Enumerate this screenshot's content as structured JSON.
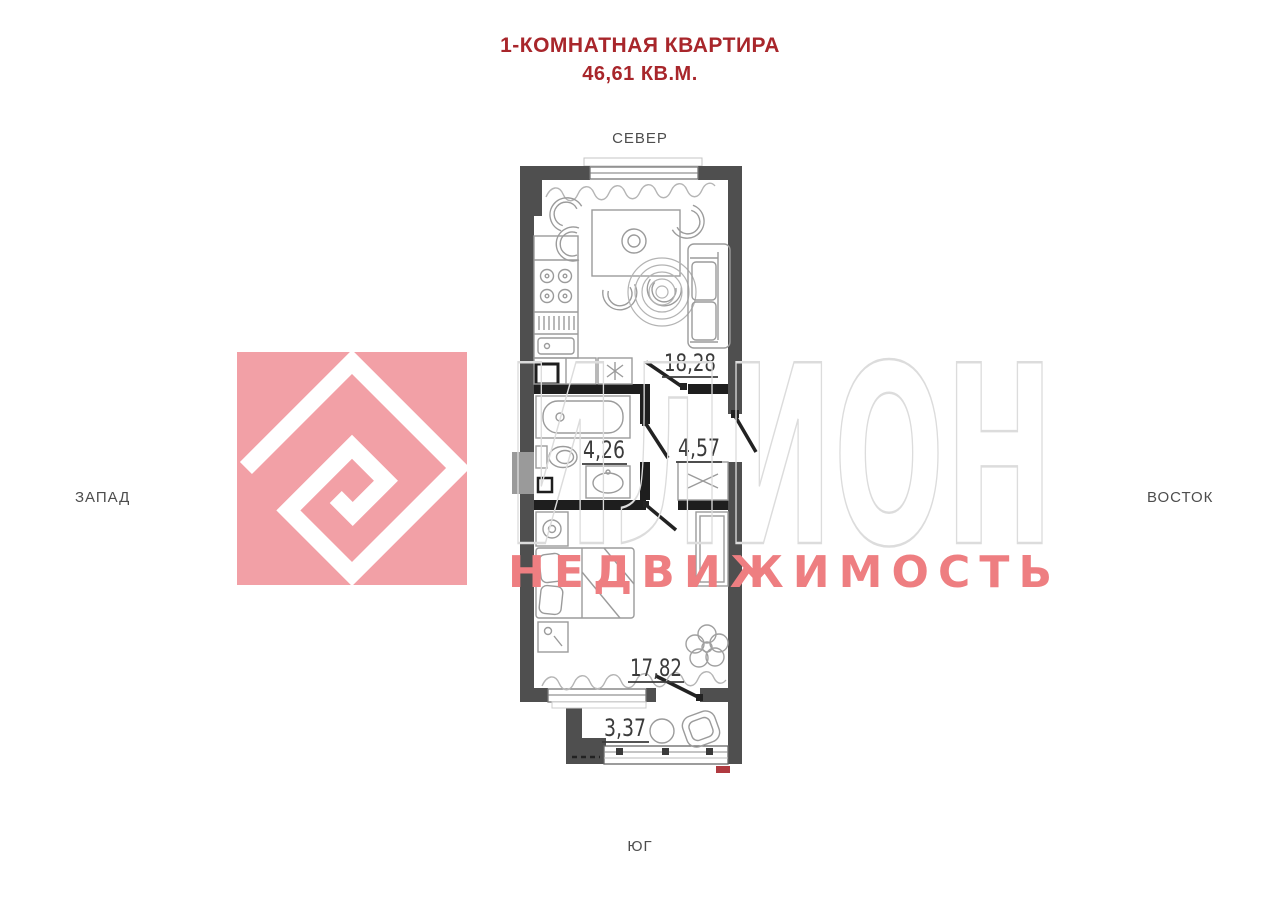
{
  "title": {
    "line1": "1-КОМНАТНАЯ КВАРТИРА",
    "line2": "46,61 КВ.М."
  },
  "compass": {
    "north": "СЕВЕР",
    "south": "ЮГ",
    "west": "ЗАПАД",
    "east": "ВОСТОК"
  },
  "watermark": {
    "brand": "ИЛИОН",
    "subtitle": "НЕДВИЖИМОСТЬ",
    "logo_color": "#f2a0a6",
    "brand_outline_color": "#dcdcdc",
    "subtitle_color": "#ee7e81"
  },
  "plan": {
    "rooms": [
      {
        "id": "kitchen-living-room",
        "area": "18,28"
      },
      {
        "id": "bathroom",
        "area": "4,26"
      },
      {
        "id": "hallway",
        "area": "4,57"
      },
      {
        "id": "bedroom",
        "area": "17,82"
      },
      {
        "id": "balcony",
        "area": "3,37"
      }
    ]
  },
  "colors": {
    "title_red": "#a8262b",
    "wall_gray": "#4f4f4f",
    "partition_black": "#1e1e1e",
    "furniture_gray": "#9b9b9b",
    "label_gray": "#3b3b3b",
    "balcony_mark_red": "#b03a40"
  }
}
